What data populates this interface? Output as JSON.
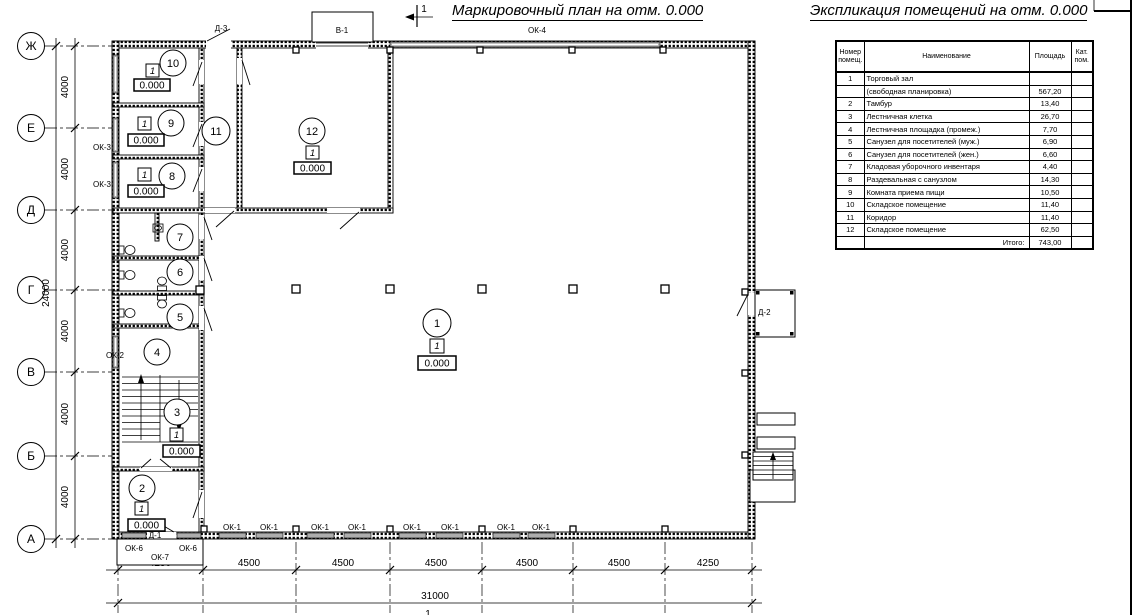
{
  "titles": {
    "plan_title": "Маркировочный план на отм. 0.000",
    "table_title": "Экспликация помещений на отм. 0.000",
    "section_mark_top": "1",
    "section_mark_bottom": "1"
  },
  "plan": {
    "axis_rows": [
      "Ж",
      "Е",
      "Д",
      "Г",
      "В",
      "Б",
      "А"
    ],
    "dim_left_segments": [
      "4000",
      "4000",
      "4000",
      "4000",
      "4000",
      "4000"
    ],
    "dim_left_total": "24000",
    "dim_bottom_segments": [
      "4250",
      "4500",
      "4500",
      "4500",
      "4500",
      "4500",
      "4250"
    ],
    "dim_bottom_total": "31000",
    "labels": {
      "ok1": "ОК-1",
      "ok2": "ОК-2",
      "ok3": "ОК-3",
      "ok4": "ОК-4",
      "ok6": "ОК-6",
      "ok7": "ОК-7",
      "d1": "Д-1",
      "d2": "Д-2",
      "d3": "Д-3",
      "v1": "В-1"
    },
    "rooms": {
      "r1": {
        "num": "1",
        "type": "1",
        "elev": "0.000"
      },
      "r2": {
        "num": "2",
        "type": "1",
        "elev": "0.000"
      },
      "r3": {
        "num": "3",
        "type": "1",
        "elev": "0.000"
      },
      "r4": {
        "num": "4"
      },
      "r5": {
        "num": "5"
      },
      "r6": {
        "num": "6"
      },
      "r7": {
        "num": "7"
      },
      "r8": {
        "num": "8",
        "type": "1",
        "elev": "0.000"
      },
      "r9": {
        "num": "9",
        "type": "1",
        "elev": "0.000"
      },
      "r10": {
        "num": "10",
        "type": "1",
        "elev": "0.000"
      },
      "r11": {
        "num": "11"
      },
      "r12": {
        "num": "12",
        "type": "1",
        "elev": "0.000"
      }
    }
  },
  "table": {
    "headers": {
      "num": "Номер помещ.",
      "name": "Наименование",
      "area": "Площадь",
      "cat": "Кат. пом."
    },
    "rows": [
      [
        "1",
        "Торговый зал",
        ""
      ],
      [
        "",
        "(свободная планировка)",
        "567,20"
      ],
      [
        "2",
        "Тамбур",
        "13,40"
      ],
      [
        "3",
        "Лестничная клетка",
        "26,70"
      ],
      [
        "4",
        "Лестничная площадка (промеж.)",
        "7,70"
      ],
      [
        "5",
        "Санузел для посетителей (муж.)",
        "6,90"
      ],
      [
        "6",
        "Санузел для посетителей (жен.)",
        "6,60"
      ],
      [
        "7",
        "Кладовая уборочного инвентаря",
        "4,40"
      ],
      [
        "8",
        "Раздевальная с санузлом",
        "14,30"
      ],
      [
        "9",
        "Комната приема пищи",
        "10,50"
      ],
      [
        "10",
        "Складское помещение",
        "11,40"
      ],
      [
        "11",
        "Коридор",
        "11,40"
      ],
      [
        "12",
        "Складское помещение",
        "62,50"
      ],
      [
        "",
        "Итого:",
        "743,00"
      ]
    ]
  }
}
